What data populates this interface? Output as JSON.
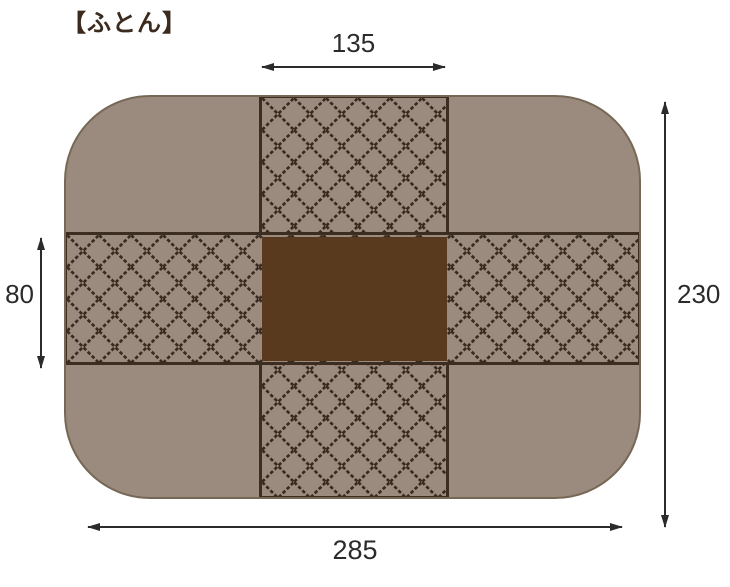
{
  "title": "【ふとん】",
  "diagram": {
    "type": "futon-dimension-diagram",
    "fabric_areas": {
      "corner_panels": "plain fabric",
      "cross_bands": "diamond quilted fabric",
      "center_panel": "dark solid panel"
    },
    "dimensions": {
      "center_width": "135",
      "band_height": "80",
      "overall_height": "230",
      "overall_width": "285"
    },
    "colors": {
      "page_bg": "#ffffff",
      "fabric": "#9b8b7e",
      "hatch_line": "#382a20",
      "seam": "#3c2d21",
      "center_panel": "#5a3a1e",
      "outline": "#776856",
      "dimension": "#2b2b2b",
      "title_text": "#3b2b1e"
    }
  }
}
